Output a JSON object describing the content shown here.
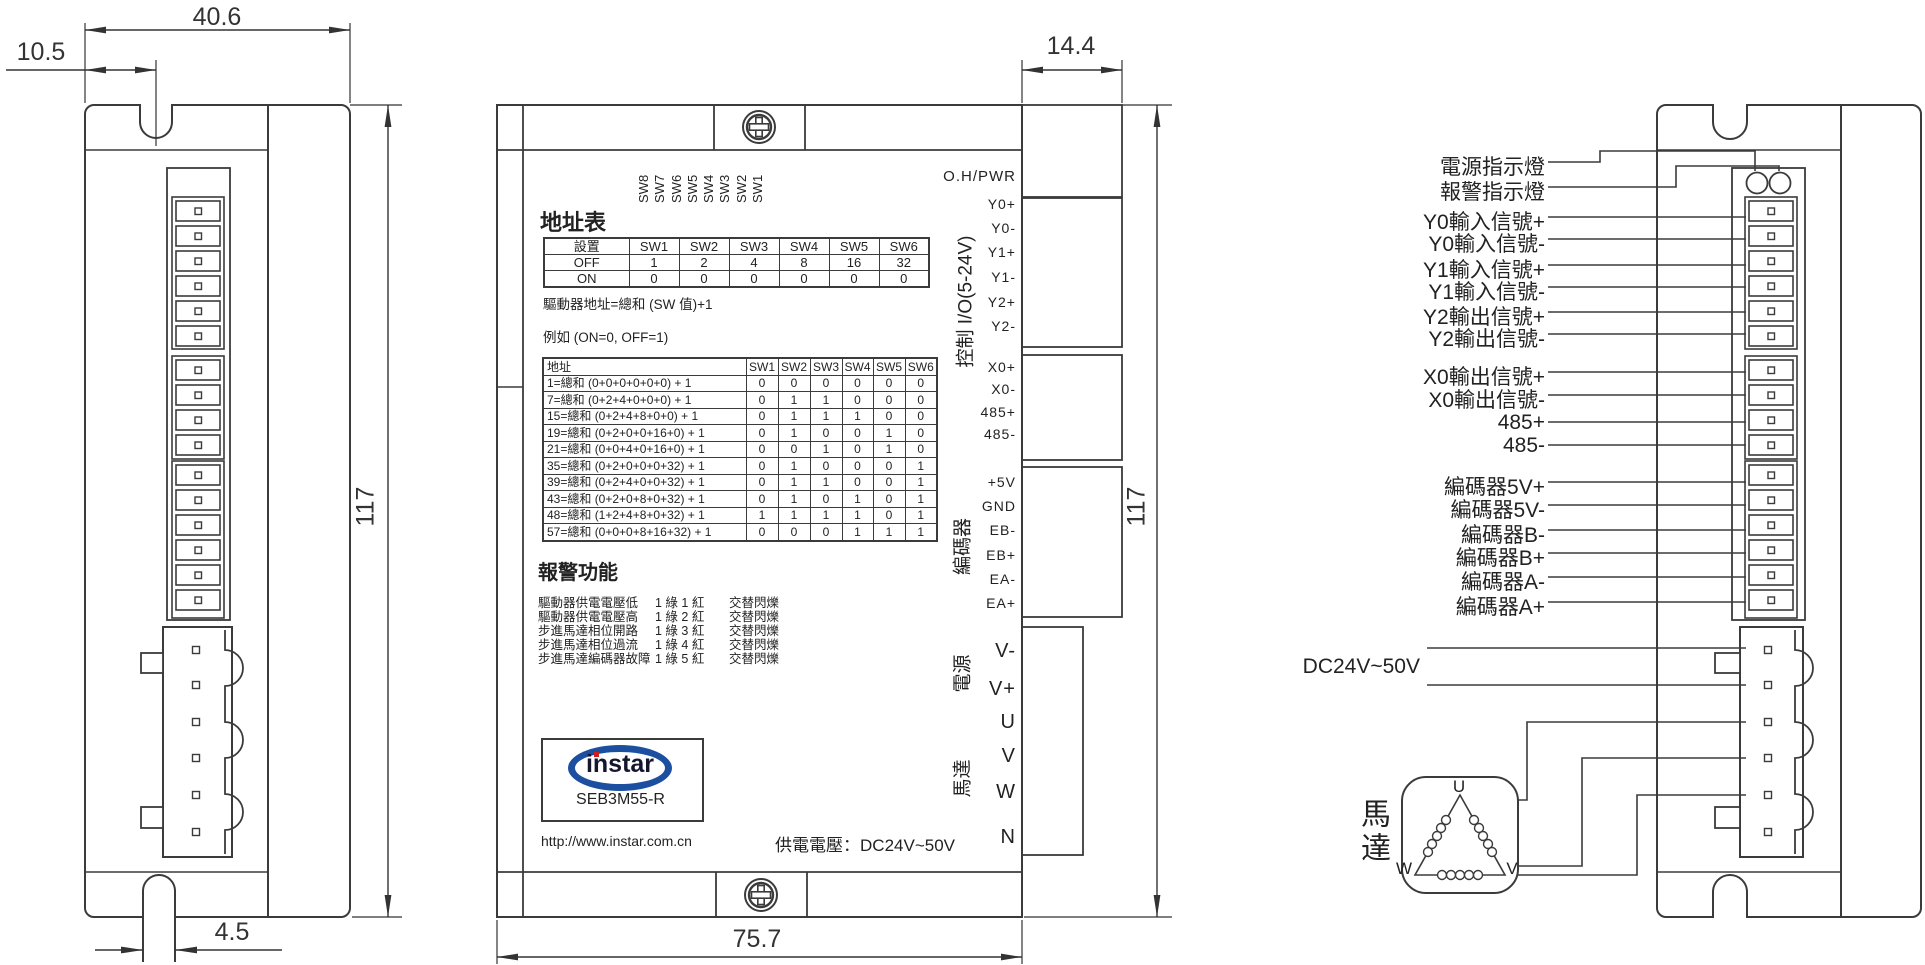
{
  "diagram": {
    "left_view": {
      "dim_width": "40.6",
      "dim_offset": "10.5",
      "dim_height": "117",
      "dim_slot": "4.5"
    },
    "front_view": {
      "dim_step": "14.4",
      "dim_height": "117",
      "dim_width": "75.7",
      "status_label": "O.H/PWR",
      "sw_labels": [
        "SW8",
        "SW7",
        "SW6",
        "SW5",
        "SW4",
        "SW3",
        "SW2",
        "SW1"
      ],
      "address_section": {
        "title": "地址表",
        "grid": [
          [
            "設置",
            "SW1",
            "SW2",
            "SW3",
            "SW4",
            "SW5",
            "SW6"
          ],
          [
            "OFF",
            "1",
            "2",
            "4",
            "8",
            "16",
            "32"
          ],
          [
            "ON",
            "0",
            "0",
            "0",
            "0",
            "0",
            "0"
          ]
        ],
        "note1": "驅動器地址=總和 (SW 值)+1",
        "note2": "例如 (ON=0, OFF=1)"
      },
      "example_section": {
        "grid": [
          [
            "地址",
            "SW1",
            "SW2",
            "SW3",
            "SW4",
            "SW5",
            "SW6"
          ],
          [
            "1=總和 (0+0+0+0+0+0) + 1",
            "0",
            "0",
            "0",
            "0",
            "0",
            "0"
          ],
          [
            "7=總和 (0+2+4+0+0+0) + 1",
            "0",
            "1",
            "1",
            "0",
            "0",
            "0"
          ],
          [
            "15=總和 (0+2+4+8+0+0) + 1",
            "0",
            "1",
            "1",
            "1",
            "0",
            "0"
          ],
          [
            "19=總和 (0+2+0+0+16+0) + 1",
            "0",
            "1",
            "0",
            "0",
            "1",
            "0"
          ],
          [
            "21=總和 (0+0+4+0+16+0) + 1",
            "0",
            "0",
            "1",
            "0",
            "1",
            "0"
          ],
          [
            "35=總和 (0+2+0+0+0+32) + 1",
            "0",
            "1",
            "0",
            "0",
            "0",
            "1"
          ],
          [
            "39=總和 (0+2+4+0+0+32) + 1",
            "0",
            "1",
            "1",
            "0",
            "0",
            "1"
          ],
          [
            "43=總和 (0+2+0+8+0+32) + 1",
            "0",
            "1",
            "0",
            "1",
            "0",
            "1"
          ],
          [
            "48=總和 (1+2+4+8+0+32) + 1",
            "1",
            "1",
            "1",
            "1",
            "0",
            "1"
          ],
          [
            "57=總和 (0+0+0+8+16+32) + 1",
            "0",
            "0",
            "0",
            "1",
            "1",
            "1"
          ]
        ]
      },
      "alarm_section": {
        "title": "報警功能",
        "rows": [
          {
            "name": "驅動器供電電壓低",
            "code": "1 綠 1 紅",
            "mode": "交替閃爍"
          },
          {
            "name": "驅動器供電電壓高",
            "code": "1 綠 2 紅",
            "mode": "交替閃爍"
          },
          {
            "name": "步進馬達相位開路",
            "code": "1 綠 3 紅",
            "mode": "交替閃爍"
          },
          {
            "name": "步進馬達相位過流",
            "code": "1 綠 4 紅",
            "mode": "交替閃爍"
          },
          {
            "name": "步進馬達編碼器故障",
            "code": "1 綠 5 紅",
            "mode": "交替閃爍"
          }
        ]
      },
      "logo": {
        "brand": "instar",
        "model": "SEB3M55-R"
      },
      "url": "http://www.instar.com.cn",
      "supply": "供電電壓：DC24V~50V",
      "groups": {
        "io": "控制 I/O(5-24V)",
        "encoder": "編碼器",
        "power": "電源",
        "motor": "馬達"
      },
      "pins": {
        "io": [
          "Y0+",
          "Y0-",
          "Y1+",
          "Y1-",
          "Y2+",
          "Y2-",
          "X0+",
          "X0-",
          "485+",
          "485-"
        ],
        "encoder": [
          "+5V",
          "GND",
          "EB-",
          "EB+",
          "EA-",
          "EA+"
        ],
        "power": [
          "V-",
          "V+"
        ],
        "motor": [
          "U",
          "V",
          "W",
          "N"
        ]
      }
    },
    "wiring": {
      "labels": [
        "電源指示燈",
        "報警指示燈",
        "Y0輸入信號+",
        "Y0輸入信號-",
        "Y1輸入信號+",
        "Y1輸入信號-",
        "Y2輸出信號+",
        "Y2輸出信號-",
        "X0輸出信號+",
        "X0輸出信號-",
        "485+",
        "485-",
        "編碼器5V+",
        "編碼器5V-",
        "編碼器B-",
        "編碼器B+",
        "編碼器A-",
        "編碼器A+"
      ],
      "supply": "DC24V~50V",
      "motor": {
        "label": "馬達",
        "u": "U",
        "v": "V",
        "w": "W"
      }
    }
  }
}
